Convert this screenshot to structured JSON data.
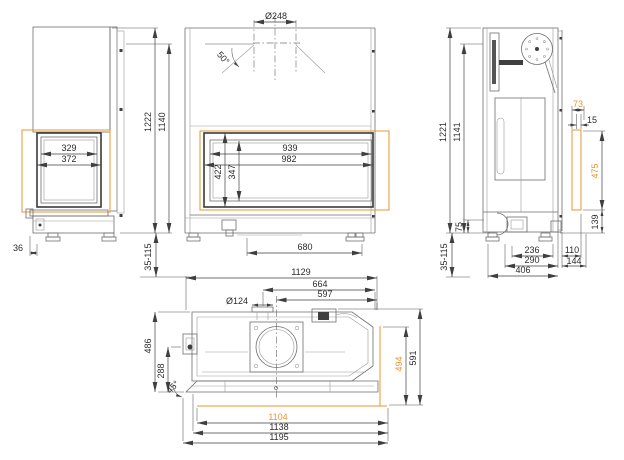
{
  "drawing": {
    "type": "fireplace-insert-dimension-drawing",
    "colors": {
      "accent": "#E8962E",
      "line": "#6E6E6E",
      "dim_text": "#2B2B2B"
    },
    "labels": [
      {
        "id": "side-glass-width-inner",
        "text": "329",
        "x": 69,
        "y": 151
      },
      {
        "id": "side-glass-width-outer",
        "text": "372",
        "x": 69,
        "y": 162
      },
      {
        "id": "side-offset",
        "text": "36",
        "x": 18,
        "y": 251
      },
      {
        "id": "total-height-left",
        "text": "1222",
        "x": 151,
        "y": 122,
        "rot": -90
      },
      {
        "id": "frame-height-left",
        "text": "1140",
        "x": 165,
        "y": 122,
        "rot": -90
      },
      {
        "id": "leg-range-left",
        "text": "35-115",
        "x": 151,
        "y": 257,
        "rot": -90
      },
      {
        "id": "flue-diameter",
        "text": "Ø248",
        "x": 276,
        "y": 19
      },
      {
        "id": "flue-angle",
        "text": "50°",
        "x": 221,
        "y": 60,
        "rot": 48
      },
      {
        "id": "front-glass-width-inner",
        "text": "939",
        "x": 290,
        "y": 151
      },
      {
        "id": "front-glass-width-outer",
        "text": "982",
        "x": 289,
        "y": 162
      },
      {
        "id": "front-glass-height-outer",
        "text": "422",
        "x": 221,
        "y": 172,
        "rot": -90
      },
      {
        "id": "front-glass-height-inner",
        "text": "347",
        "x": 235,
        "y": 172,
        "rot": -90
      },
      {
        "id": "base-width",
        "text": "680",
        "x": 305,
        "y": 250
      },
      {
        "id": "total-height-right",
        "text": "1221",
        "x": 446,
        "y": 132,
        "rot": -90
      },
      {
        "id": "frame-height-right",
        "text": "1141",
        "x": 460,
        "y": 132,
        "rot": -90
      },
      {
        "id": "glass-offset",
        "text": "73",
        "x": 578,
        "y": 107,
        "accent": true
      },
      {
        "id": "frame-offset",
        "text": "15",
        "x": 592,
        "y": 123
      },
      {
        "id": "side-glass-depth",
        "text": "475",
        "x": 598,
        "y": 171,
        "rot": -90,
        "accent": true
      },
      {
        "id": "base-height-right",
        "text": "139",
        "x": 598,
        "y": 222,
        "rot": -90
      },
      {
        "id": "plinth-height",
        "text": "75",
        "x": 462,
        "y": 227,
        "rot": -90
      },
      {
        "id": "depth-upper",
        "text": "236",
        "x": 532,
        "y": 253
      },
      {
        "id": "front-depth-upper",
        "text": "110",
        "x": 572,
        "y": 253
      },
      {
        "id": "base-depth",
        "text": "290",
        "x": 532,
        "y": 263
      },
      {
        "id": "front-depth-lower",
        "text": "144",
        "x": 574,
        "y": 264
      },
      {
        "id": "total-depth",
        "text": "406",
        "x": 523,
        "y": 273
      },
      {
        "id": "leg-range-right",
        "text": "35-115",
        "x": 447,
        "y": 257,
        "rot": -90
      },
      {
        "id": "top-width",
        "text": "1129",
        "x": 301,
        "y": 275
      },
      {
        "id": "intake-offset",
        "text": "664",
        "x": 320,
        "y": 287
      },
      {
        "id": "flue-offset",
        "text": "597",
        "x": 325,
        "y": 297
      },
      {
        "id": "intake-diameter",
        "text": "Ø124",
        "x": 237,
        "y": 304
      },
      {
        "id": "top-depth-outer",
        "text": "486",
        "x": 151,
        "y": 346,
        "rot": -90
      },
      {
        "id": "top-depth-inner",
        "text": "288",
        "x": 164,
        "y": 371,
        "rot": -90
      },
      {
        "id": "corner-angle",
        "text": "45°",
        "x": 175,
        "y": 389,
        "rot": -46
      },
      {
        "id": "glass-depth-top",
        "text": "494",
        "x": 402,
        "y": 364,
        "rot": -90,
        "accent": true
      },
      {
        "id": "total-depth-top",
        "text": "591",
        "x": 416,
        "y": 358,
        "rot": -90
      },
      {
        "id": "glass-width-top",
        "text": "1104",
        "x": 278,
        "y": 420,
        "accent": true
      },
      {
        "id": "frame-width-top",
        "text": "1138",
        "x": 279,
        "y": 430
      },
      {
        "id": "total-width-top",
        "text": "1195",
        "x": 279,
        "y": 440
      }
    ]
  }
}
